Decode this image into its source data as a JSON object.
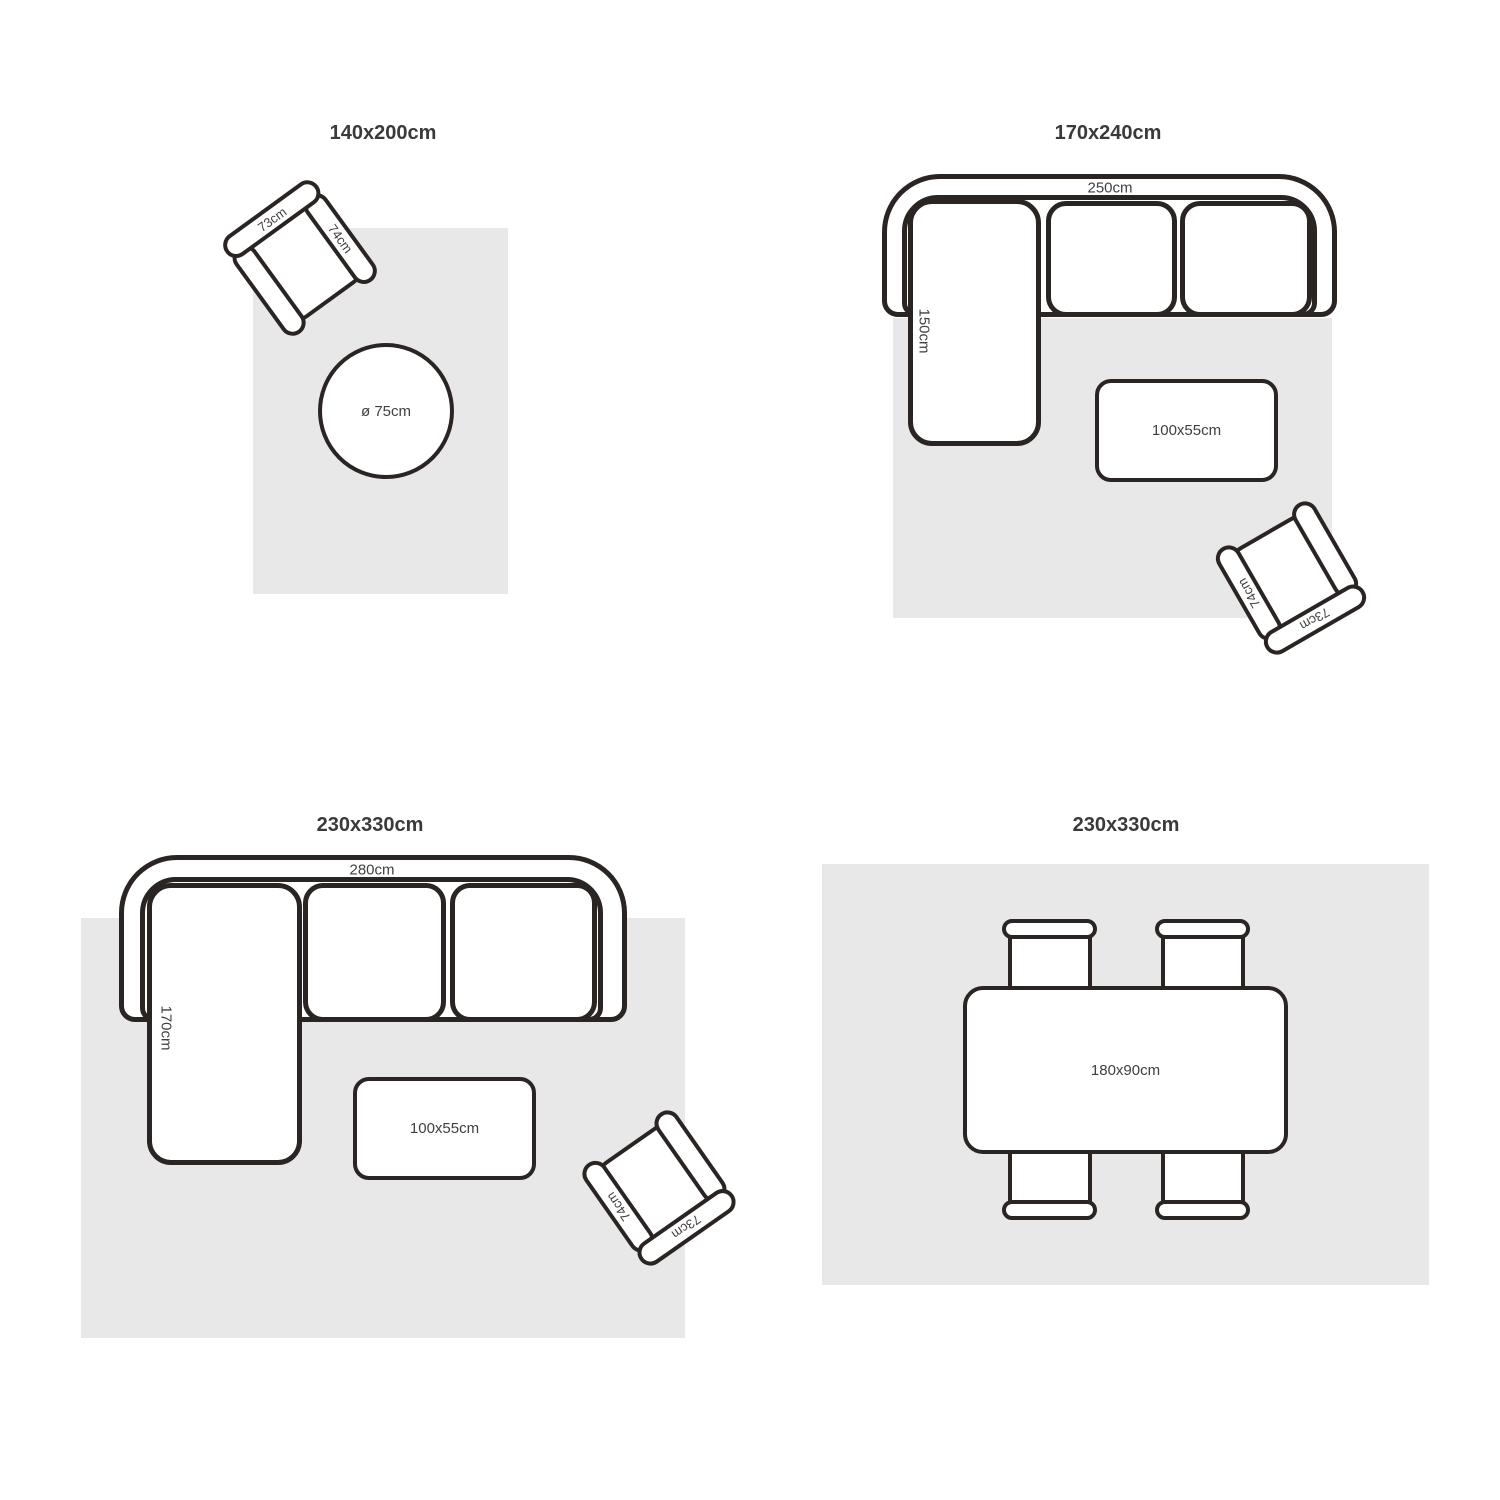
{
  "colors": {
    "stroke": "#2a2523",
    "rug": "#e9e8e8",
    "title_text": "#3a3a3a",
    "label_text": "#404040"
  },
  "panels": [
    {
      "title": "140x200cm",
      "armchair": {
        "back_label": "73cm",
        "arm_label": "74cm"
      },
      "round_table_label": "ø 75cm"
    },
    {
      "title": "170x240cm",
      "sofa": {
        "width_label": "250cm",
        "chaise_label": "150cm"
      },
      "coffee_table_label": "100x55cm",
      "armchair": {
        "back_label": "73cm",
        "arm_label": "74cm"
      }
    },
    {
      "title": "230x330cm",
      "sofa": {
        "width_label": "280cm",
        "chaise_label": "170cm"
      },
      "coffee_table_label": "100x55cm",
      "armchair": {
        "back_label": "73cm",
        "arm_label": "74cm"
      }
    },
    {
      "title": "230x330cm",
      "dining_table_label": "180x90cm"
    }
  ]
}
